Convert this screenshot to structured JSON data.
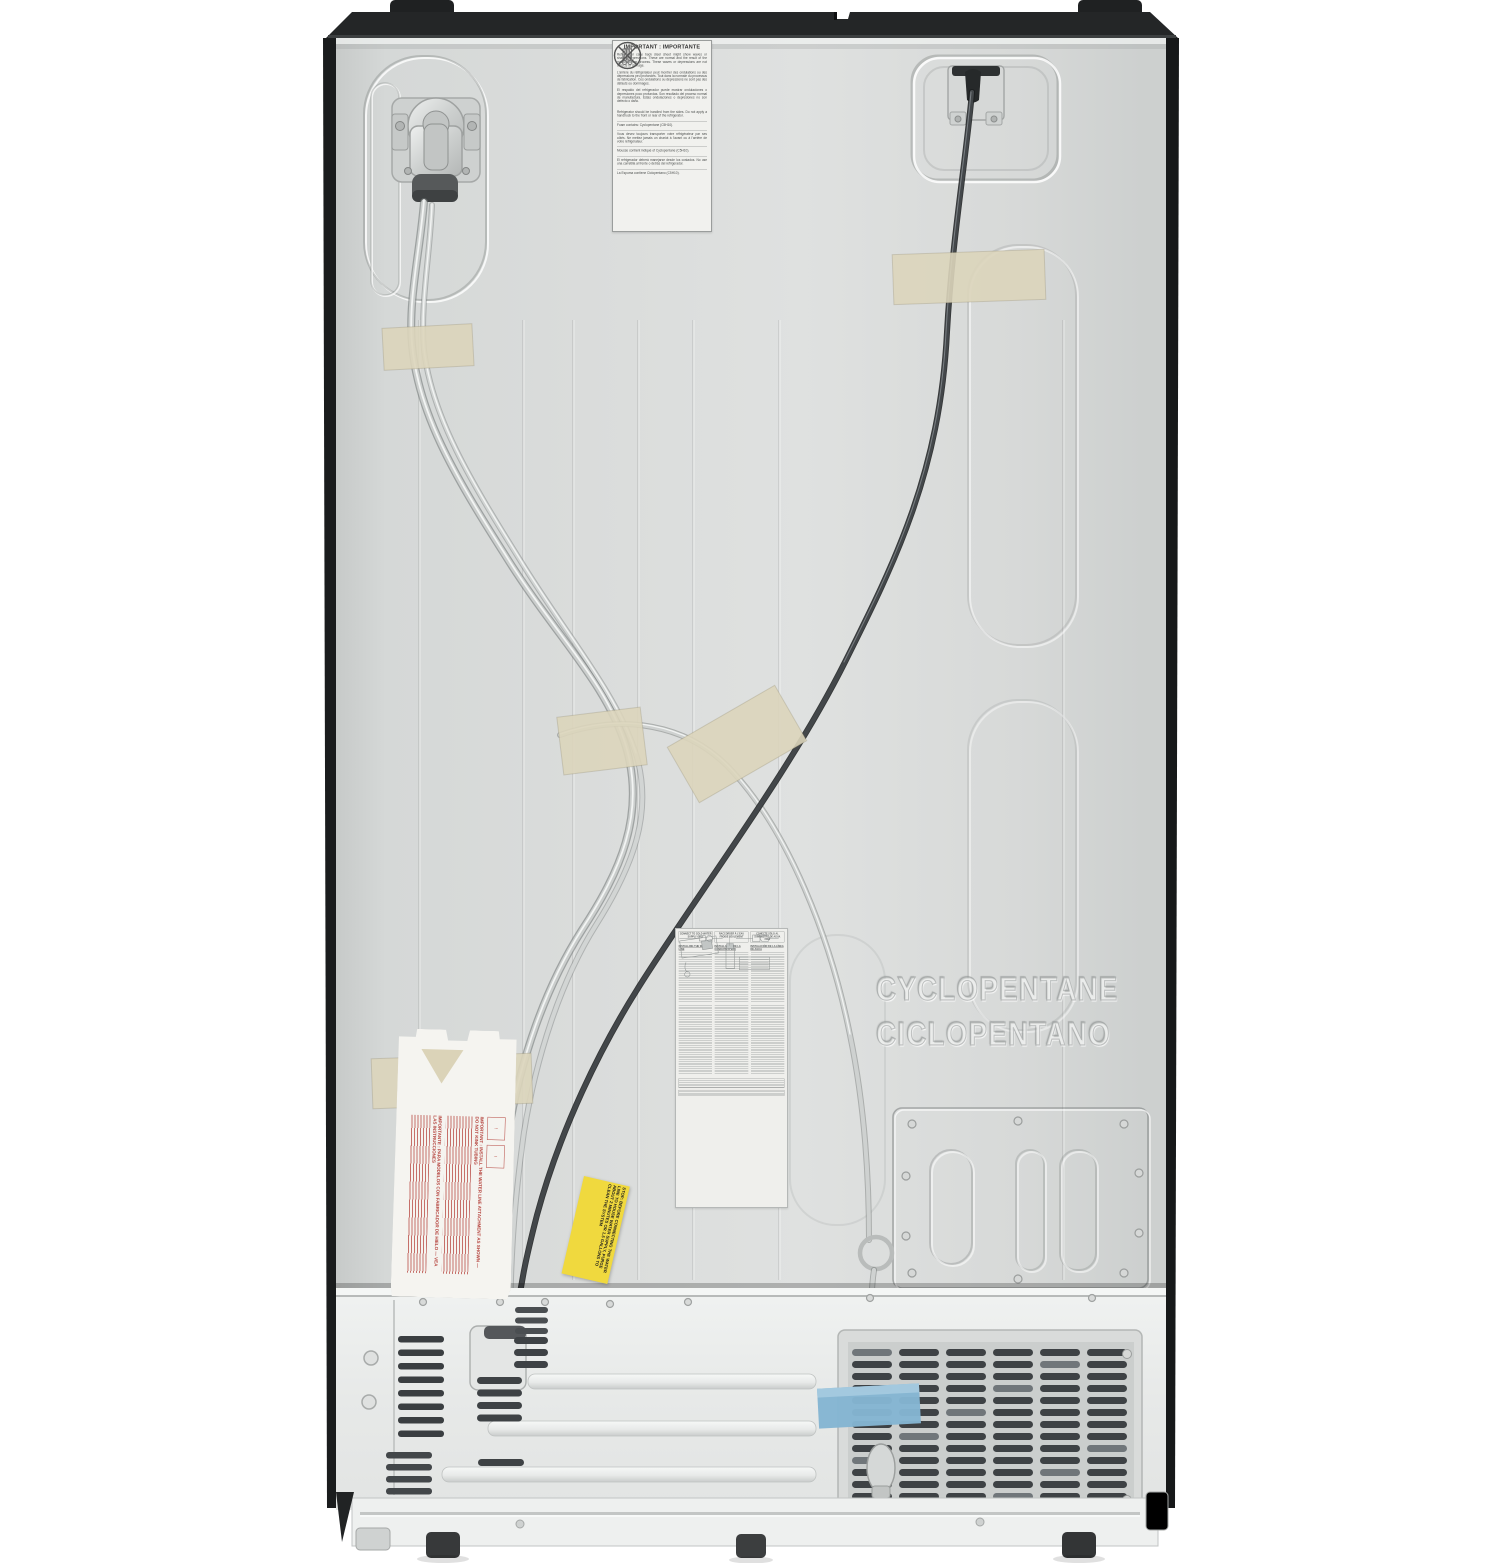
{
  "photo": {
    "description": "Rear view of a side-by-side refrigerator with black cabinet sides, bare metal back panel, taped water lines and power cord, compressor compartment and ventilation grille at the bottom",
    "colors": {
      "background": "#ffffff",
      "cabinet_black": "#232526",
      "panel_gray": "#d8dad9",
      "cover_white": "#e9ebea",
      "tape_beige": "#dcd5bb",
      "tape_blue": "#84b5d2",
      "sticker_yellow": "#f0d93e",
      "warning_red": "#b5443e",
      "cord_dark": "#3d4144",
      "tube_gray": "#c9cccb"
    },
    "labels": {
      "important": {
        "title": "IMPORTANT : IMPORTANTE",
        "para_en": "Refrigerator case back steel sheet might show waves or shallow depressions. These are normal and the result of the manufacturing process. These waves or depressions are not defects or damage.",
        "para_fr": "L'arrière du réfrigérateur peut montrer des ondulations ou des dépressions peu profondes. Tout dans la normale du processus de fabrication. Ces ondulations ou dépressions ne sont pas des défauts ou dommages.",
        "para_es": "El respaldo del refrigerador puede mostrar ondulaciones o depresiones poco profundas. Son resultado del proceso normal de manufactura. Estas ondulaciones o depresiones no son defecto o daño.",
        "handling_en": "Refrigerator should be handled from the sides. Do not apply a handtruck to the front or rear of the refrigerator.",
        "foam_en": "Foam contains: Cyclopentane (C5H10).",
        "handling_fr": "Vous devez toujours transporter votre réfrigérateur par ses côtés. Ne mettez jamais un chariot à l'avant ou à l'arrière de votre réfrigérateur.",
        "foam_fr": "Mousse contient indiqué of Cyclopentane (C5H10).",
        "handling_es": "El refrigerador deberá manejarse desde los costados. No use una carretilla al frente o detrás del refrigerador.",
        "foam_es": "La Espuma contiene Ciclopentano (C5H10)."
      },
      "install": {
        "warn_en": "CONNECT TO COLD WATER SUPPLY ONLY",
        "warn_fr": "RACCORDER À L'EAU FROIDE SEULEMENT",
        "warn_es": "CONECTE SÓLO AL SUMINISTRO DE AGUA FRÍA",
        "title_en": "INSTALLING THE WATER LINE",
        "title_fr": "INSTALLATION DE LA CONDUITE D'EAU",
        "title_es": "INSTALACIÓN DE LA LÍNEA DE AGUA"
      },
      "cardboard": {
        "icon1": "!",
        "icon2": "!",
        "heading_en": "IMPORTANT : INSTALL THE WATER LINE ATTACHMENT AS SHOWN — DO NOT KINK TUBING",
        "heading_es": "IMPORTANTE : PARA MODELOS CON FABRICADOR DE HIELO — VEA LAS INSTRUCCIONES"
      },
      "yellow": {
        "text": "STOP: BEFORE CONNECTING THE WATER LINE TO HOUSE WATER SUPPLY, PURGE ABOUT 2 MINUTES OR 1.5 GALLONS TO CLEAN THE SYSTEM"
      },
      "embossed": {
        "line1": "CYCLOPENTANE",
        "line2": "CICLOPENTANO"
      }
    }
  }
}
